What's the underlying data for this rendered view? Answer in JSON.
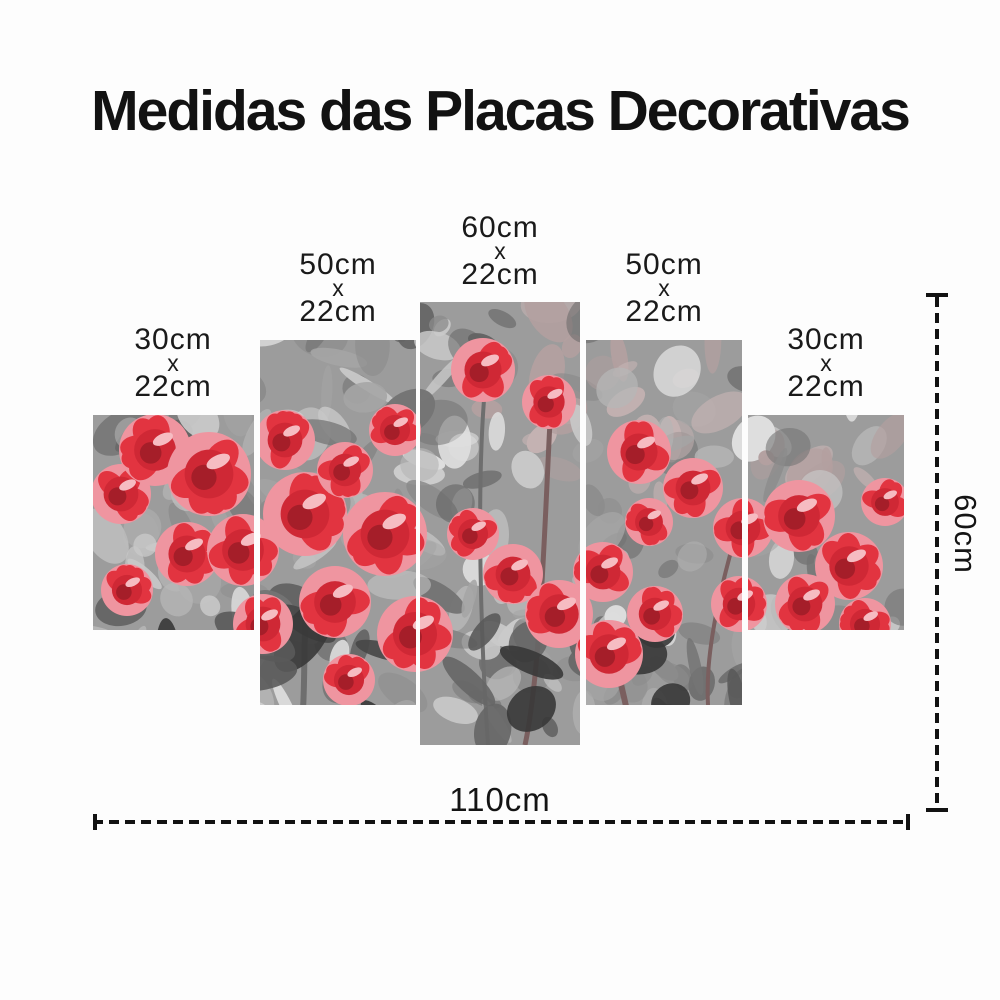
{
  "title": "Medidas das Placas Decorativas",
  "panels": [
    {
      "height_cm": "30cm",
      "times": "x",
      "width_cm": "22cm"
    },
    {
      "height_cm": "50cm",
      "times": "x",
      "width_cm": "22cm"
    },
    {
      "height_cm": "60cm",
      "times": "x",
      "width_cm": "22cm"
    },
    {
      "height_cm": "50cm",
      "times": "x",
      "width_cm": "22cm"
    },
    {
      "height_cm": "30cm",
      "times": "x",
      "width_cm": "22cm"
    }
  ],
  "overall_dimensions": {
    "total_width": "110cm",
    "total_height": "60cm"
  },
  "artwork": {
    "description": "Five-piece canvas print of red roses with selective-color effect on a posterized grayscale background",
    "colors": {
      "rose_red": "#e23440",
      "rose_mid": "#cf2835",
      "rose_core_dark": "#a51e29",
      "rose_pink": "#ef95a0",
      "rose_highlight": "#f6bcc2",
      "background_gray": "#9c9c9c",
      "foliage_dark": "#474747",
      "mauve_tint": "#b3a0a0",
      "line_black": "#121212"
    }
  }
}
